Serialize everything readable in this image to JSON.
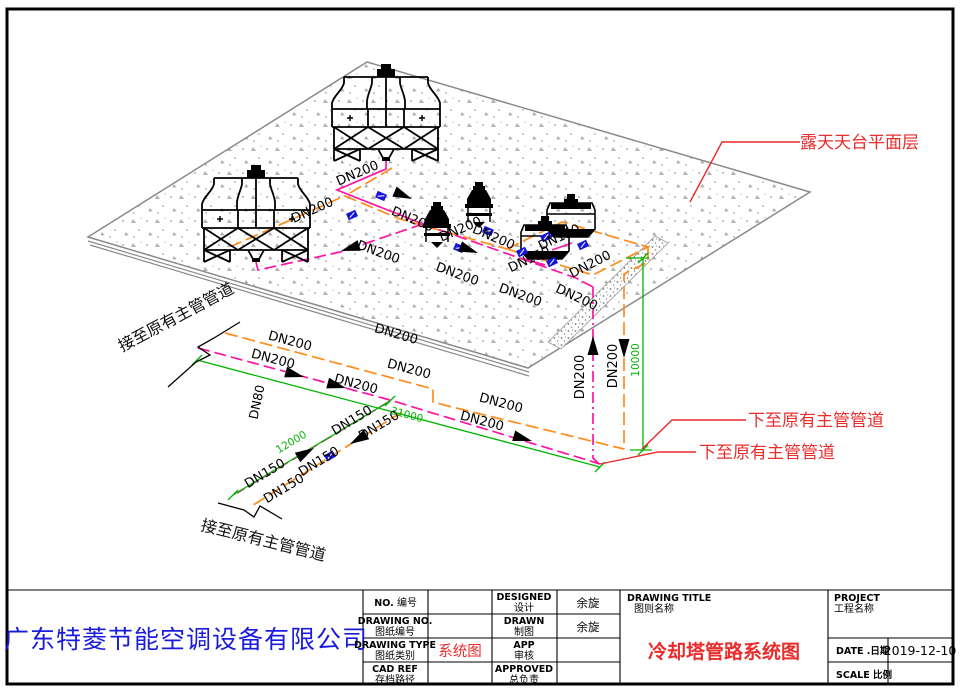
{
  "drawing": {
    "pipe_labels": {
      "dn200": "DN200",
      "dn150": "DN150",
      "dn80": "DN80"
    },
    "dims": {
      "d10000": "10000",
      "d31000": "31000",
      "d12000": "12000"
    },
    "annotations": {
      "roof_level": "露天天台平面层",
      "down_to_main_1": "下至原有主管管道",
      "down_to_main_2": "下至原有主管管道",
      "connect_existing_top": "接至原有主管管道",
      "connect_existing_bottom": "接至原有主管管道"
    },
    "colors": {
      "pipe_supply_orange": "#ff8c1a",
      "pipe_return_magenta": "#ff14a3",
      "dimension_green": "#00b400",
      "leader_red": "#e92c2c",
      "valve_blue": "#1616d6"
    }
  },
  "titleblock": {
    "company": "广东特菱节能空调设备有限公司",
    "no_label_en": "NO.",
    "no_label_cn": "编号",
    "no_value": "",
    "drawing_no_en": "DRAWING NO.",
    "drawing_no_cn": "图纸编号",
    "drawing_no_value": "",
    "drawing_type_en": "DRAWING TYPE",
    "drawing_type_cn": "图纸类别",
    "drawing_type_value": "系统图",
    "cad_ref_en": "CAD REF",
    "cad_ref_cn": "存档路径",
    "cad_ref_value": "",
    "designed_en": "DESIGNED",
    "designed_cn": "设计",
    "designed_value": "余旋",
    "drawn_en": "DRAWN",
    "drawn_cn": "制图",
    "drawn_value": "余旋",
    "app_en": "APP",
    "app_cn": "审核",
    "app_value": "",
    "approved_en": "APPROVED",
    "approved_cn": "总负责",
    "approved_value": "",
    "drawing_title_en": "DRAWING TITLE",
    "drawing_title_cn": "图则名称",
    "drawing_title_value": "冷却塔管路系统图",
    "project_en": "PROJECT",
    "project_cn": "工程名称",
    "project_value": "",
    "date_label": "DATE .日期",
    "date_value": "2019-12-10",
    "scale_label": "SCALE 比例",
    "scale_value": ""
  }
}
